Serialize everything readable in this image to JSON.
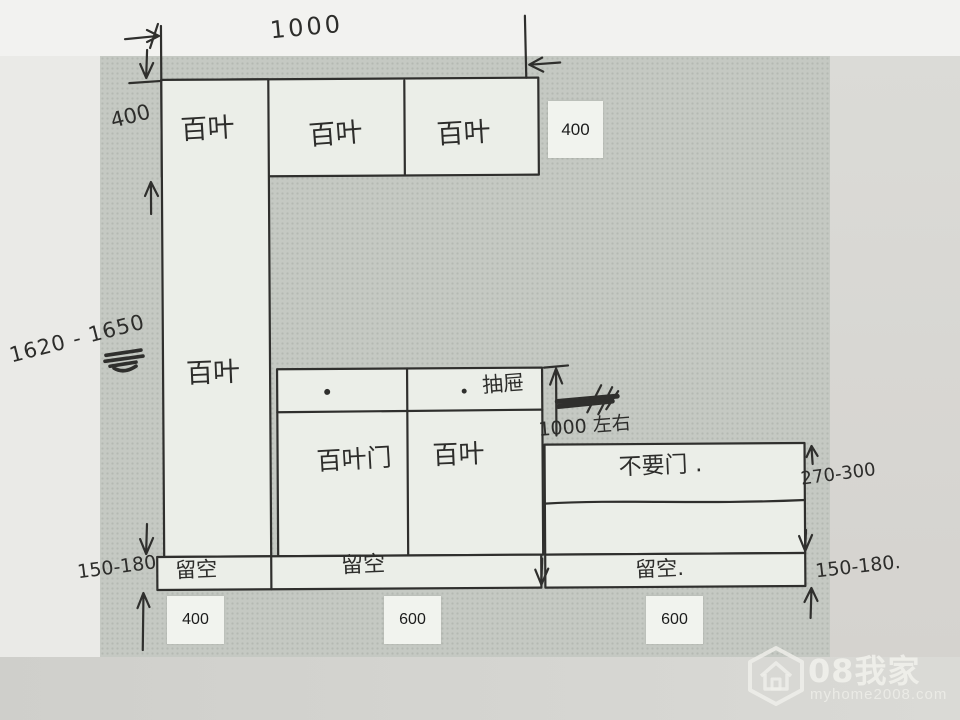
{
  "sketch": {
    "labels": {
      "width_top": "1000",
      "height_top": "400",
      "overall_height": "1620 - 1650",
      "mid_height": "1000 左右",
      "right_height": "270-300",
      "gap_left": "150-180",
      "gap_right": "150-180.",
      "top_cells": [
        "百叶",
        "百叶",
        "百叶"
      ],
      "tall_cell": "百叶",
      "mid_cells": [
        "百叶门",
        "百叶"
      ],
      "drawer": "抽屉",
      "right_cell": "不要门 .",
      "bottom_cells": [
        "留空",
        "留空",
        "留空."
      ]
    },
    "printed_labels": {
      "top_depth": "400",
      "bottom_widths": [
        "400",
        "600",
        "600"
      ]
    }
  },
  "watermark": {
    "brand": "08我家",
    "site": "myhome2008.com"
  },
  "colors": {
    "ink": "#2d2d2b",
    "paper_scan": "#c5c9c3",
    "cell_fill": "#ebeee8",
    "printed_box_bg": "#f1f3ee",
    "watermark": "#f0f0eb"
  }
}
